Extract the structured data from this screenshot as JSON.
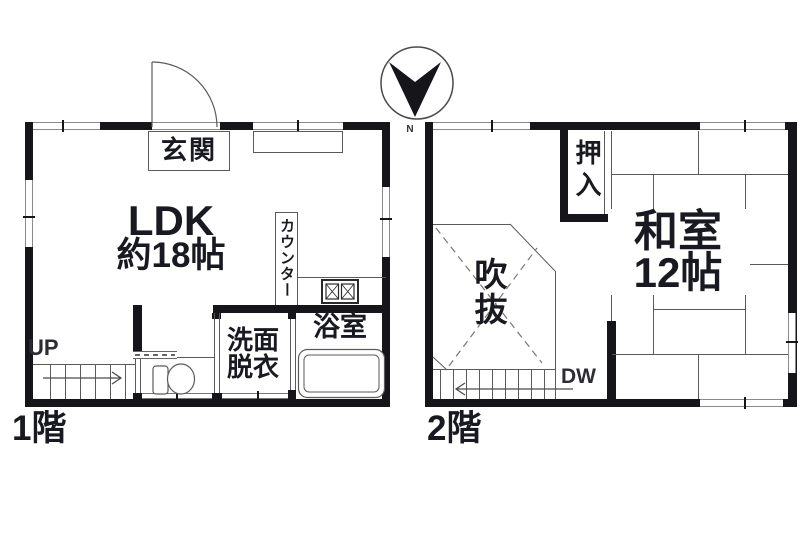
{
  "compass": {
    "north_label": "N"
  },
  "floor1": {
    "floor_label": "1階",
    "entrance_label": "玄関",
    "ldk_name": "LDK",
    "ldk_size": "約18帖",
    "counter_label": "カウンター",
    "washroom_line1": "洗面",
    "washroom_line2": "脱衣",
    "bathroom_label": "浴室",
    "stairs_label": "UP"
  },
  "floor2": {
    "floor_label": "2階",
    "closet_label": "押入",
    "japanese_room_name": "和室",
    "japanese_room_size": "12帖",
    "void_label": "吹抜",
    "stairs_label": "DW"
  },
  "colors": {
    "wall": "#16161a",
    "thin_line": "#5a5a5a",
    "text": "#191922"
  }
}
